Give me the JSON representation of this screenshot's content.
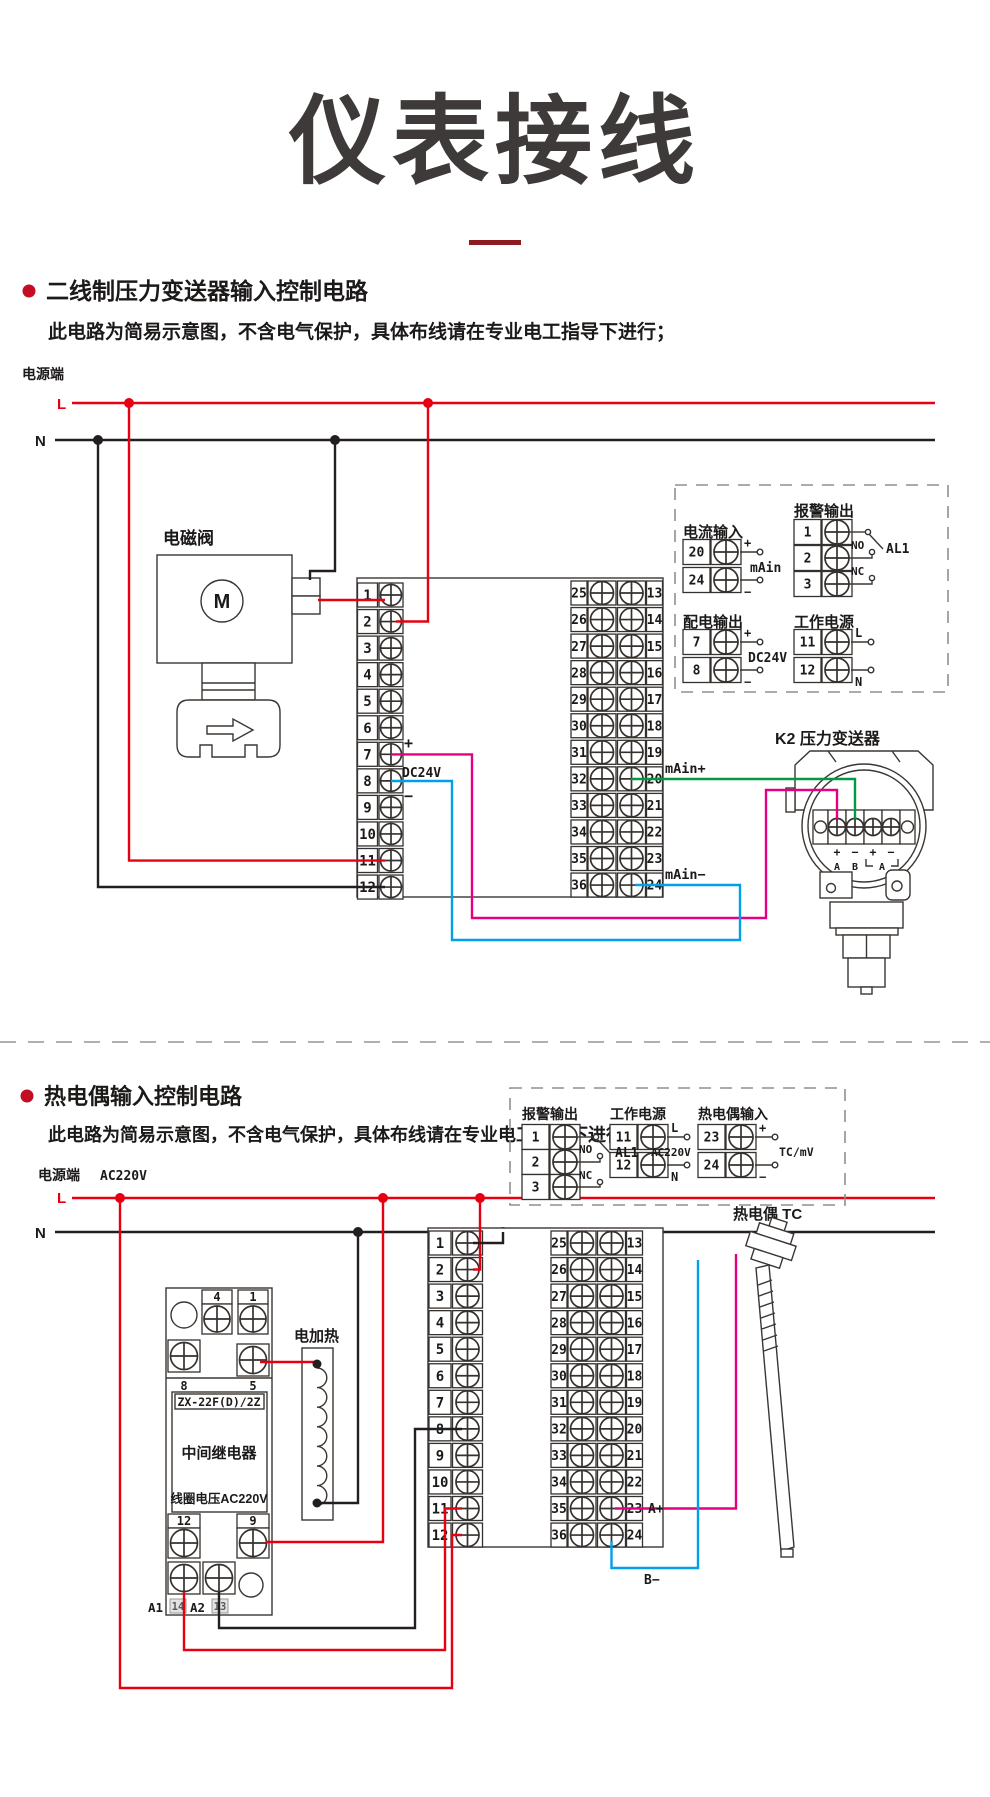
{
  "page": {
    "title": "仪表接线"
  },
  "strips": {
    "left": [
      "1",
      "2",
      "3",
      "4",
      "5",
      "6",
      "7",
      "8",
      "9",
      "10",
      "11",
      "12"
    ],
    "dual_left": [
      "25",
      "26",
      "27",
      "28",
      "29",
      "30",
      "31",
      "32",
      "33",
      "34",
      "35",
      "36"
    ],
    "dual_right": [
      "13",
      "14",
      "15",
      "16",
      "17",
      "18",
      "19",
      "20",
      "21",
      "22",
      "23",
      "24"
    ]
  },
  "section1": {
    "heading": "二线制压力变送器输入控制电路",
    "note": "此电路为简易示意图，不含电气保护，具体布线请在专业电工指导下进行；",
    "power_label": "电源端",
    "live": "L",
    "neutral": "N",
    "solenoid": {
      "label": "电磁阀",
      "mark": "M"
    },
    "dc_plus": "+",
    "dc_minus": "−",
    "dc_label": "DC24V",
    "main_plus": "mAin+",
    "main_minus": "mAin−",
    "transmitter": {
      "label": "K2 压力变送器",
      "marks": [
        "+",
        "−",
        "+",
        "−"
      ],
      "groups": [
        "A",
        "B",
        "A"
      ]
    },
    "legend": {
      "current_input": {
        "title": "电流输入",
        "terminals": [
          {
            "no": "20",
            "mark": "+"
          },
          {
            "no": "24",
            "mark": "−"
          }
        ],
        "label": "mAin"
      },
      "alarm": {
        "title": "报警输出",
        "terminals": [
          {
            "no": "1"
          },
          {
            "no": "2"
          },
          {
            "no": "3"
          }
        ],
        "no_label": "NO",
        "nc_label": "NC",
        "relay_label": "AL1"
      },
      "dist_output": {
        "title": "配电输出",
        "terminals": [
          {
            "no": "7",
            "mark": "+"
          },
          {
            "no": "8",
            "mark": "−"
          }
        ],
        "label": "DC24V"
      },
      "work_power": {
        "title": "工作电源",
        "terminals": [
          {
            "no": "11",
            "mark": "L"
          },
          {
            "no": "12",
            "mark": "N"
          }
        ]
      }
    }
  },
  "section2": {
    "heading": "热电偶输入控制电路",
    "note": "此电路为简易示意图，不含电气保护，具体布线请在专业电工指导下进行；",
    "power_label": "电源端",
    "voltage": "AC220V",
    "live": "L",
    "neutral": "N",
    "heater_label": "电加热",
    "relay": {
      "model": "ZX-22F(D)/2Z",
      "name": "中间继电器",
      "coil": "线圈电压AC220V",
      "t4": "4",
      "t1": "1",
      "t8": "8",
      "t5": "5",
      "t12": "12",
      "t9": "9",
      "a1": "A1",
      "n14": "14",
      "a2": "A2",
      "n13": "13"
    },
    "tc_label": "热电偶 TC",
    "a_plus": "A+",
    "b_minus": "B−",
    "legend": {
      "alarm": {
        "title": "报警输出",
        "ter minals_note": "",
        "terminals": [
          {
            "no": "1"
          },
          {
            "no": "2"
          },
          {
            "no": "3"
          }
        ],
        "no_label": "NO",
        "nc_label": "NC",
        "relay_label": "AL1"
      },
      "work_power": {
        "title": "工作电源",
        "terminals": [
          {
            "no": "11",
            "mark": "L"
          },
          {
            "no": "12",
            "mark": "N"
          }
        ],
        "label": "AC220V"
      },
      "tc_input": {
        "title": "热电偶输入",
        "terminals": [
          {
            "no": "23",
            "mark": "+"
          },
          {
            "no": "24",
            "mark": "−"
          }
        ],
        "label": "TC/mV"
      }
    }
  }
}
